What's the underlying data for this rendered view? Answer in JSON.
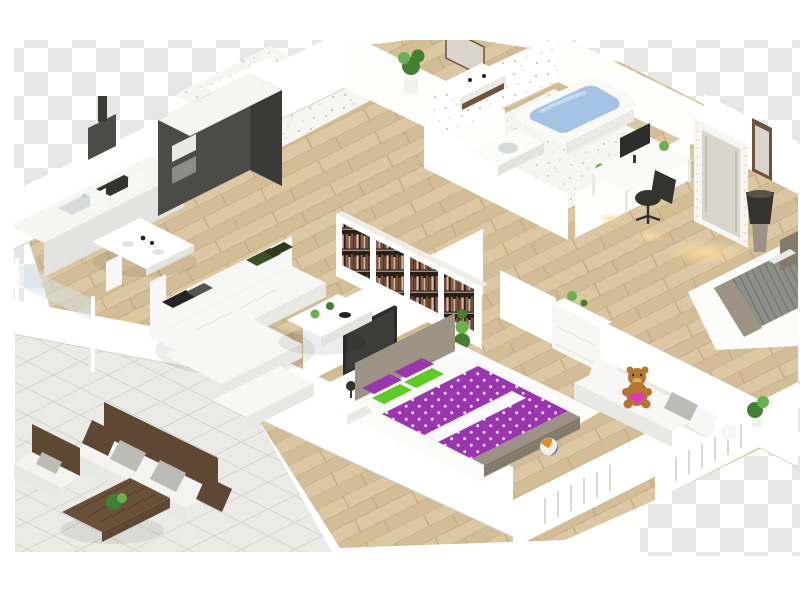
{
  "scene": {
    "type": "isometric-3d-floor-plan",
    "description": "3D isometric floor plan render of a furnished apartment on a transparent checkerboard background: kitchen with dark cabinets, dining table, white corner sofa with bookshelf and TV wall, bathroom with blue bathtub, entry hall, workspace with desk and illuminated mirror, gray bed bedroom, master bedroom with purple polka-dot bed, kids corner with teddy bear sofa, and a tiled terrace with outdoor furniture.",
    "background": "transparent-checkerboard",
    "rooms": [
      {
        "name": "Kitchen",
        "items": [
          "dark tall cabinet block with ovens",
          "white counter run",
          "sink",
          "dark cooktop",
          "range hood",
          "orange kettle"
        ]
      },
      {
        "name": "Dining area",
        "items": [
          "white dining table",
          "four white chairs",
          "table settings"
        ]
      },
      {
        "name": "Living room",
        "items": [
          "white modular corner sofa",
          "dark green cushion",
          "black cushion",
          "white coffee table with plants",
          "bookshelf wall with books",
          "wall mounted TV",
          "white media bench",
          "spiral topiary plant"
        ]
      },
      {
        "name": "Bathroom",
        "items": [
          "bathtub with blue water",
          "white vanity with basin",
          "speckled tile walls"
        ]
      },
      {
        "name": "Entry hall",
        "items": [
          "wall console shelf",
          "wall mirror",
          "potted plant"
        ]
      },
      {
        "name": "Workspace",
        "items": [
          "white desk",
          "monitor",
          "black office chair",
          "illuminated leaning mirror",
          "dark doorway"
        ]
      },
      {
        "name": "Bedroom",
        "items": [
          "gray ribbed bed",
          "taupe headboard",
          "white rug",
          "dark floor lamp on pedestal"
        ]
      },
      {
        "name": "Master bedroom",
        "items": [
          "double bed with purple polka-dot duvet",
          "white sheet band",
          "green polka-dot pillows",
          "purple pillows",
          "taupe bed frame",
          "two white nightstands with dark lamps",
          "white rug",
          "radiator wall"
        ]
      },
      {
        "name": "Kids corner",
        "items": [
          "white sofa",
          "brown teddy bear with pink heart",
          "gray cushion",
          "white dresser with plant",
          "multicolor toy ball",
          "white pouf",
          "green plant",
          "radiator wall"
        ]
      },
      {
        "name": "Terrace",
        "items": [
          "white tiled floor",
          "glass railing with posts",
          "wooden outdoor sofa with white cushions",
          "wooden outdoor armchair",
          "gray outdoor pillows",
          "wooden coffee table with green planter"
        ]
      }
    ]
  },
  "colors": {
    "canvas": "#ffffff",
    "checker": "#e7e7e7",
    "wood1": "#dcc7a3",
    "wood2": "#d3bd96",
    "woodSeam": "#c3ab83",
    "tile": "#eaeae6",
    "tileLine": "#d5d5cf",
    "wall": "#ffffff",
    "wallFace": "#fdfdfc",
    "wallShade": "#e9e9e5",
    "wallEdge": "#d2d2cc",
    "speckle": "#8f8f98",
    "glass": "#d6e6ec",
    "cabinet": "#4b4b48",
    "cabinetSide": "#3a3a37",
    "counter": "#f5f5f2",
    "counterFront": "#e3e3df",
    "steel": "#c9cdcd",
    "cooktop": "#333331",
    "orangeAccent": "#e07a1e",
    "sofa": "#f7f7f5",
    "sofaShade": "#e8e8e4",
    "cushGreen": "#3e5026",
    "cushGreen2": "#2c3a1c",
    "cushBlack": "#242424",
    "bookBg": "#2b1f15",
    "bookA": "#9b5a40",
    "bookB": "#c9bfae",
    "bookC": "#6f5238",
    "bookD": "#8c3f2e",
    "shelfEdge": "#efede8",
    "tv": "#2d2d2b",
    "benchRed": "#c23b2e",
    "tubWhite": "#f9f9f7",
    "water": "#a3c2e4",
    "waterLight": "#c6daf0",
    "vanity": "#fbfbf9",
    "basin": "#d7dbdb",
    "plantDark": "#41802f",
    "plantLight": "#68b24b",
    "pot": "#f1f1ee",
    "trunk": "#7a5c3a",
    "mirrorFrame": "#f5f5f2",
    "mirrorGlass": "#d9d5cd",
    "glow": "#ffdf9f",
    "doorWood": "#6e523c",
    "desk": "#fafaf8",
    "chairBlack": "#333330",
    "rug": "#fbfbf9",
    "bedGray": "#8f8f8a",
    "bedGrayDark": "#7b7b75",
    "taupe": "#9d9384",
    "taupeDark": "#847b6d",
    "purple": "#9b34b0",
    "dotWhite": "#ffffff",
    "pGreen": "#5ecb24",
    "heart": "#e335c5",
    "teddy": "#b5772f",
    "teddySnout": "#dcae67",
    "duvetWhite": "#fafafa",
    "dresser": "#f6f6f3",
    "ball1": "#e8881c",
    "ball2": "#2f5cbe",
    "radLine": "#dadad5",
    "owood": "#5f4833",
    "ocush": "#f3f3ef",
    "opillow": "#bcbcb6",
    "terraceTable": "#6b5038"
  }
}
